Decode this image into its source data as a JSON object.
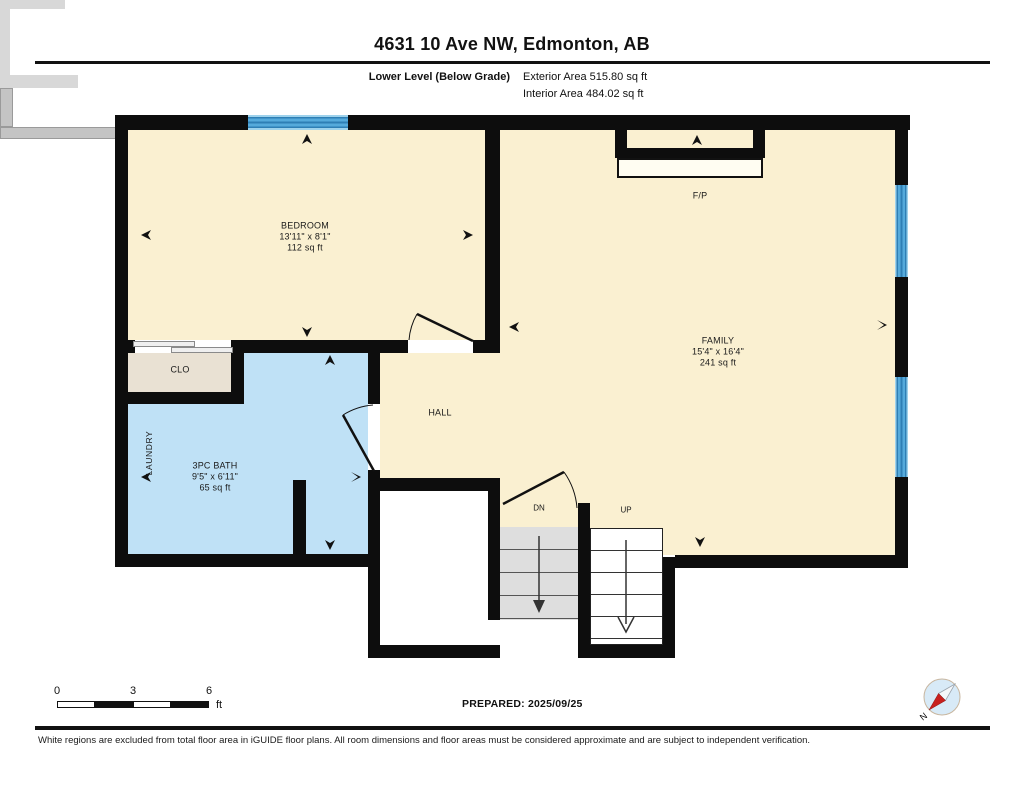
{
  "header": {
    "title": "4631 10 Ave NW, Edmonton, AB",
    "floor_label": "Lower Level (Below Grade)",
    "exterior_area": "Exterior Area 515.80 sq ft",
    "interior_area": "Interior Area 484.02 sq ft"
  },
  "rooms": {
    "bedroom": {
      "name": "BEDROOM",
      "dims": "13'11\" x 8'1\"",
      "area": "112 sq ft"
    },
    "family": {
      "name": "FAMILY",
      "dims": "15'4\" x 16'4\"",
      "area": "241 sq ft"
    },
    "bath": {
      "name": "3PC BATH",
      "dims": "9'5\" x 6'11\"",
      "area": "65 sq ft"
    },
    "closet": {
      "name": "CLO"
    },
    "laundry": {
      "name": "LAUNDRY"
    },
    "hall": {
      "name": "HALL"
    },
    "fireplace": {
      "name": "F/P"
    },
    "stairs_down": {
      "name": "DN"
    },
    "stairs_up": {
      "name": "UP"
    }
  },
  "scale_bar": {
    "tick_0": "0",
    "tick_3": "3",
    "tick_6": "6",
    "unit": "ft"
  },
  "footer": {
    "prepared": "PREPARED: 2025/09/25",
    "disclaimer": "White regions are excluded from total floor area in iGUIDE floor plans. All room dimensions and floor areas must be considered approximate and are subject to independent verification."
  },
  "compass": {
    "north_label": "N"
  },
  "colors": {
    "room_fill": "#FAF0D1",
    "bath_fill": "#BFE1F6",
    "closet_fill": "#E9E1D3",
    "wall": "#0D0D0D",
    "window_blue": "#55AADB",
    "window_blue_dark": "#2E7FB5",
    "stair_gray": "#DEDEDE",
    "ledge_gray": "#C4C4C4",
    "compass_red": "#C8201E"
  }
}
